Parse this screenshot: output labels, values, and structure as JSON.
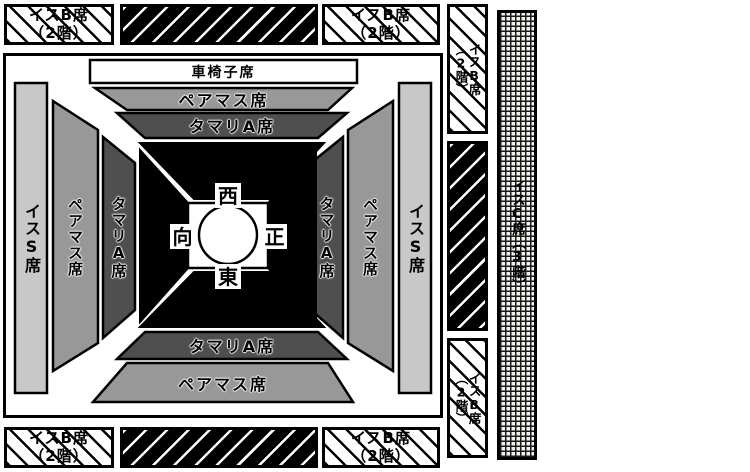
{
  "seat_map": {
    "outer_seats": {
      "isu_b_label": "イスB席",
      "isu_b_floor": "（2階）",
      "isu_c_label": "イスC席（3階）"
    },
    "inner_seats": {
      "wheelchair": "車椅子席",
      "pair_masu": "ペアマス席",
      "tamari_a": "タマリA席",
      "isu_s": "イスS席"
    },
    "dohyo": {
      "west": "西",
      "east": "東",
      "front": "正",
      "opposite": "向"
    },
    "colors": {
      "isu_s_fill": "#c8c8c8",
      "pair_masu_fill": "#989898",
      "tamari_a_fill": "#4f4f4f",
      "tamari_black_fill": "#000000",
      "outline": "#000000",
      "background": "#ffffff"
    }
  }
}
